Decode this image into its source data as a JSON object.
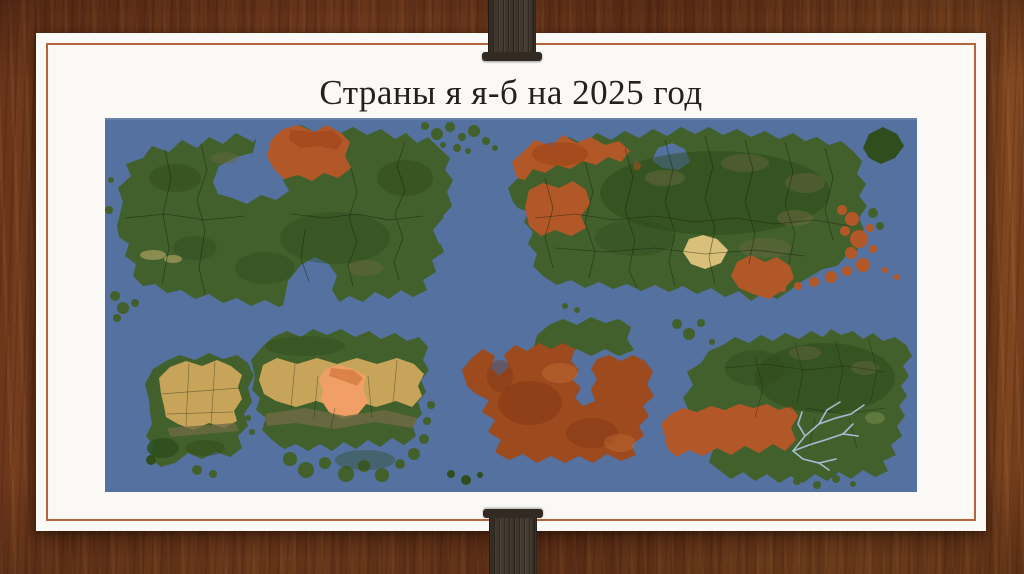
{
  "slide": {
    "title": "Страны я я-б на 2025 год"
  },
  "map": {
    "colors": {
      "ocean": "#54719f",
      "green": "#41602b",
      "green_dark": "#2f4d1d",
      "tan": "#c7a45a",
      "tan_light": "#d9c07a",
      "orange": "#b25828",
      "red_brown": "#9d4a1e",
      "salmon": "#f0a066",
      "river": "#a9c3dc"
    }
  },
  "frame": {
    "border_color": "#b2643c",
    "slide_background": "#faf9f5"
  }
}
